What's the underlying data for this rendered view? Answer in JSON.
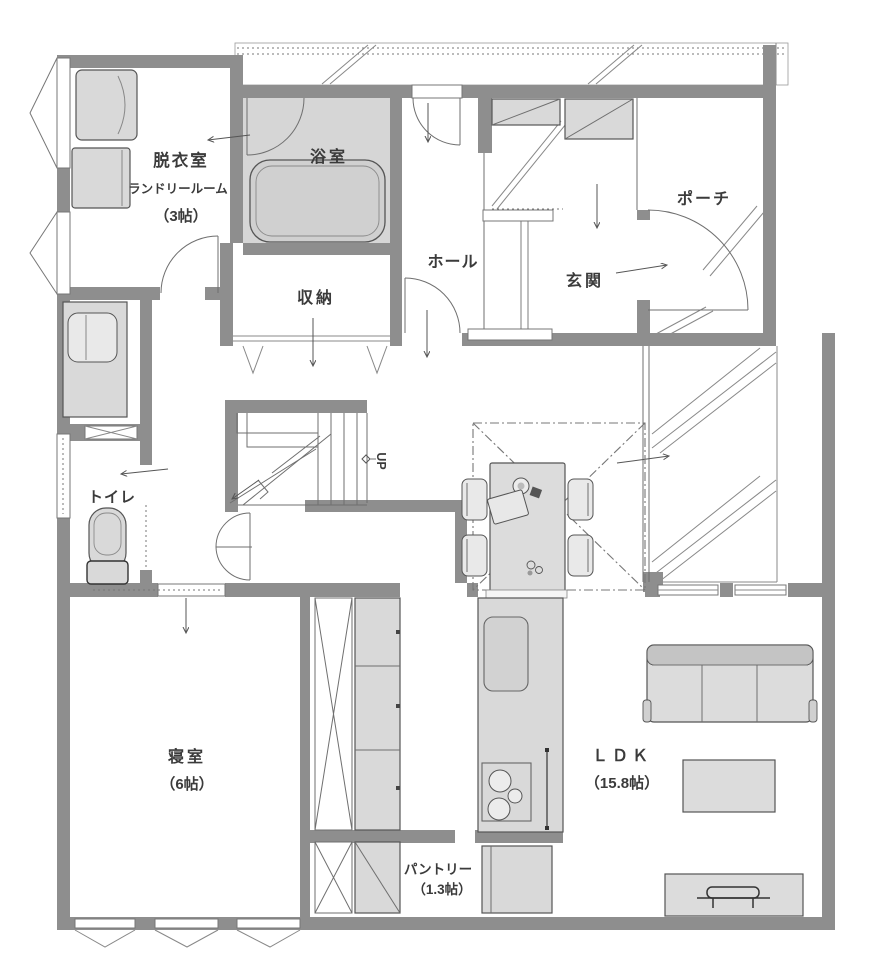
{
  "plan": {
    "type": "floor-plan-1F",
    "colors": {
      "wall": "#8e8e8e",
      "fixture_fill": "#d9d9d9",
      "bath_floor": "#d6d6d6",
      "line": "#6f6f6f",
      "text": "#3b3b3b",
      "background": "#ffffff"
    },
    "rooms": {
      "laundry": {
        "name": "脱衣室",
        "sub": "ランドリールーム",
        "size": "（3帖）"
      },
      "bath": {
        "name": "浴室"
      },
      "storage": {
        "name": "収納"
      },
      "hall": {
        "name": "ホール"
      },
      "entrance": {
        "name": "玄関"
      },
      "porch": {
        "name": "ポーチ"
      },
      "toilet": {
        "name": "トイレ"
      },
      "stairs": {
        "direction": "UP"
      },
      "bedroom": {
        "name": "寝室",
        "size": "（6帖）"
      },
      "pantry": {
        "name": "パントリー",
        "size": "（1.3帖）"
      },
      "ldk": {
        "name": "ＬＤＫ",
        "size": "（15.8帖）"
      }
    }
  }
}
